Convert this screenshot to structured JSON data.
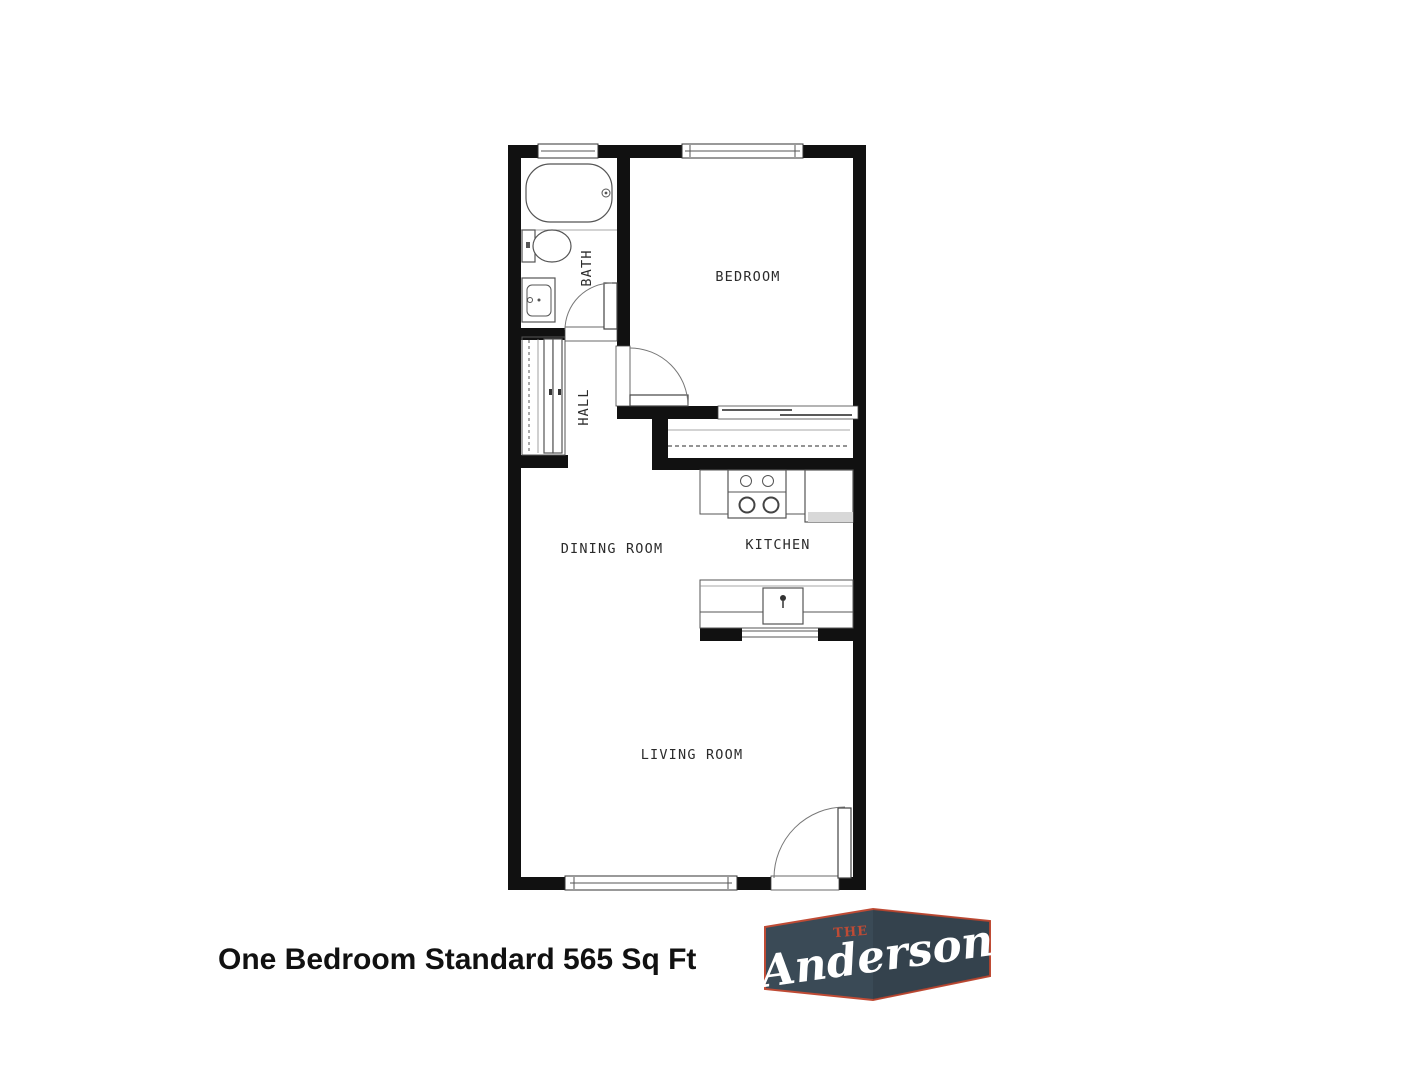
{
  "theme": {
    "wall": "#111111",
    "line": "#555555",
    "caption": "#111111",
    "logo-box": "#3a4a56",
    "logo-accent": "#bf4b35",
    "logo-text": "#ffffff"
  },
  "floor_plan": {
    "rooms": {
      "bath": "BATH",
      "hall": "HALL",
      "bedroom": "BEDROOM",
      "dining": "DINING ROOM",
      "kitchen": "KITCHEN",
      "living": "LIVING ROOM"
    }
  },
  "caption": {
    "text": "One Bedroom Standard 565 Sq Ft"
  },
  "logo": {
    "the": "THE",
    "name": "Anderson"
  }
}
